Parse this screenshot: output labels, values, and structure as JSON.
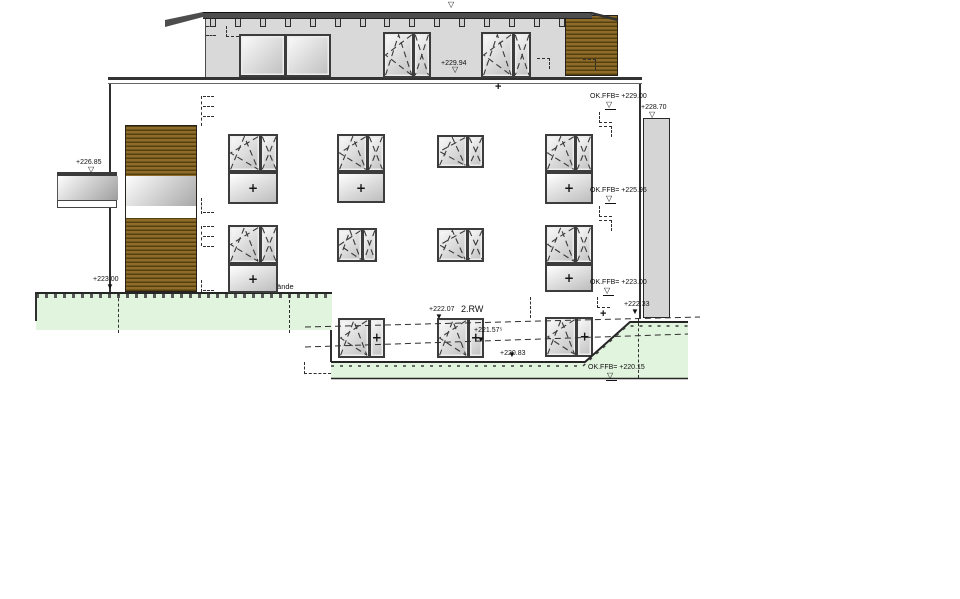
{
  "drawing": {
    "kind": "architectural elevation (CAD)",
    "labels": {
      "terrace_level": "+229.94",
      "ffb_229_00": "OK.FFB= +229.00",
      "parapet_228_70": "+228.70",
      "canopy_226_85": "+226.85",
      "ffb_225_95": "OK.FFB= +225.95",
      "ffb_223_00": "OK.FFB= +223.00",
      "terrain_222_33": "+222.33",
      "terrain_223_00": "+223.00",
      "planned_ground": "gepl. Gelände",
      "rw_level": "+222.07",
      "rw_name": "2.RW",
      "terrain_221_575": "+221.57⁵",
      "terrain_220_83": "+220.83",
      "ffb_220_15": "OK.FFB= +220.15"
    },
    "markers": {
      "open": "▽",
      "filled": "▼",
      "cross": "+"
    },
    "colors": {
      "wall_gray": "#d9d9d9",
      "roof_dark": "#4d4d4d",
      "wood_light": "#8f6c29",
      "wood_dark": "#55400f",
      "terrain_green": "#e1f4dd",
      "pillar_gray": "#d5d5d5",
      "frame_dark": "#3c3c3c",
      "line_dark": "#2a2a2a"
    }
  }
}
